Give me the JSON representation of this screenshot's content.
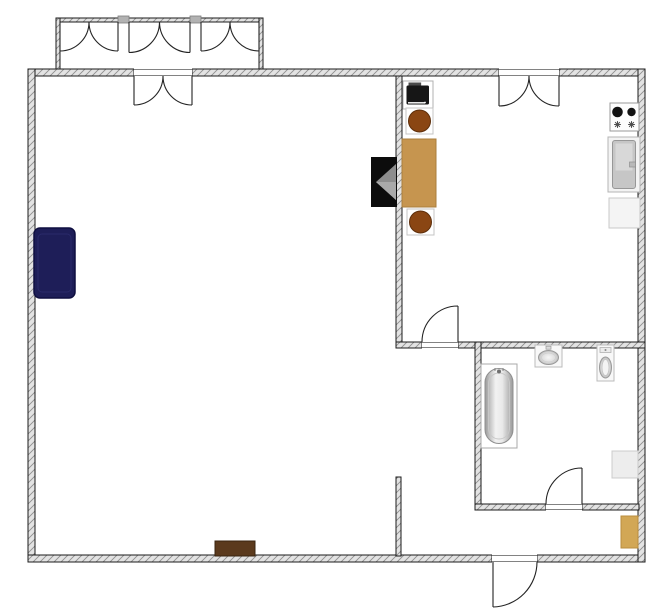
{
  "floorplan": {
    "canvas": {
      "width": 658,
      "height": 611,
      "background": "#ffffff"
    },
    "style": {
      "wall_fill": "#e3e3e3",
      "wall_hatch": "#909090",
      "wall_stroke": "#1b1b1b",
      "door_stroke": "#242424",
      "threshold_stroke": "#5a5a5a",
      "mullion_fill": "#b2b2b2",
      "mullion_stroke": "#7d7d7d"
    },
    "walls": [
      {
        "name": "top-left",
        "x": 28,
        "y": 69,
        "w": 106,
        "h": 7
      },
      {
        "name": "top-mid",
        "x": 192,
        "y": 69,
        "w": 307,
        "h": 7
      },
      {
        "name": "top-right",
        "x": 559,
        "y": 69,
        "w": 86,
        "h": 7
      },
      {
        "name": "left",
        "x": 28,
        "y": 69,
        "w": 7,
        "h": 493
      },
      {
        "name": "bottom-left",
        "x": 28,
        "y": 555,
        "w": 464,
        "h": 7
      },
      {
        "name": "bottom-right",
        "x": 537,
        "y": 555,
        "w": 108,
        "h": 7
      },
      {
        "name": "right",
        "x": 638,
        "y": 69,
        "w": 7,
        "h": 493
      },
      {
        "name": "kitchen-separator",
        "x": 396,
        "y": 76,
        "w": 6,
        "h": 266
      },
      {
        "name": "kitchen-bottom-left",
        "x": 396,
        "y": 342,
        "w": 26,
        "h": 6
      },
      {
        "name": "kitchen-bottom-right",
        "x": 458,
        "y": 342,
        "w": 187,
        "h": 6
      },
      {
        "name": "bathroom-left",
        "x": 475,
        "y": 342,
        "w": 6,
        "h": 168
      },
      {
        "name": "bathroom-bottom-left",
        "x": 475,
        "y": 504,
        "w": 71,
        "h": 6
      },
      {
        "name": "bathroom-bottom-right",
        "x": 582,
        "y": 504,
        "w": 57,
        "h": 6
      },
      {
        "name": "hall-stub",
        "x": 396,
        "y": 477,
        "w": 5,
        "h": 79
      }
    ],
    "bay": {
      "walls": [
        {
          "name": "bay-top",
          "x": 56,
          "y": 18,
          "w": 207,
          "h": 4
        },
        {
          "name": "bay-left",
          "x": 56,
          "y": 18,
          "w": 4,
          "h": 51
        },
        {
          "name": "bay-right",
          "x": 259,
          "y": 18,
          "w": 4,
          "h": 51
        }
      ],
      "mullions": [
        {
          "x": 118,
          "y": 16,
          "w": 11,
          "h": 7
        },
        {
          "x": 190,
          "y": 16,
          "w": 11,
          "h": 7
        }
      ]
    },
    "openings": [
      {
        "name": "balcony-door-opening",
        "x": 134,
        "y": 69,
        "w": 58,
        "h": 7
      },
      {
        "name": "kitchen-double-door-opening",
        "x": 499,
        "y": 69,
        "w": 60,
        "h": 7
      },
      {
        "name": "kitchen-door-opening",
        "x": 422,
        "y": 342,
        "w": 36,
        "h": 6
      },
      {
        "name": "bathroom-door-opening",
        "x": 546,
        "y": 504,
        "w": 36,
        "h": 6
      },
      {
        "name": "entrance-door-opening",
        "x": 492,
        "y": 555,
        "w": 45,
        "h": 7
      }
    ],
    "windows": [
      {
        "name": "bay-window-1-left-casement",
        "d": "M60 22 L60 51 M89 22 A29 29 0 0 1 60 51"
      },
      {
        "name": "bay-window-1-right-casement",
        "d": "M118 22 L118 51 M89 22 A29 29 0 0 0 118 51"
      },
      {
        "name": "bay-window-2-left-casement",
        "d": "M129 22 L129 52.5 M159.5 22 A30.5 30.5 0 0 1 129 52.5"
      },
      {
        "name": "bay-window-2-right-casement",
        "d": "M190 22 L190 52.5 M159.5 22 A30.5 30.5 0 0 0 190 52.5"
      },
      {
        "name": "bay-window-3-left-casement",
        "d": "M201 22 L201 51 M230 22 A29 29 0 0 1 201 51"
      },
      {
        "name": "bay-window-3-right-casement",
        "d": "M259 22 L259 51 M230 22 A29 29 0 0 0 259 51"
      }
    ],
    "doors": [
      {
        "name": "balcony-door-left-leaf",
        "d": "M134 76 L134 105 M163 76 A29 29 0 0 1 134 105"
      },
      {
        "name": "balcony-door-right-leaf",
        "d": "M192 76 L192 105 M163 76 A29 29 0 0 0 192 105"
      },
      {
        "name": "kitchen-double-door-left-leaf",
        "d": "M499 76 L499 106 M529 76 A30 30 0 0 1 499 106"
      },
      {
        "name": "kitchen-double-door-right-leaf",
        "d": "M559 76 L559 106 M529 76 A30 30 0 0 0 559 106"
      },
      {
        "name": "kitchen-door",
        "d": "M458 342 L458 306 M422 342 A36 36 0 0 1 458 306"
      },
      {
        "name": "bathroom-door",
        "d": "M582 504 L582 468 M546 504 A36 36 0 0 1 582 468"
      },
      {
        "name": "entrance-door",
        "d": "M493 562 L493 607 M537 562 A45 45 0 0 1 493 607"
      }
    ],
    "furniture": [
      {
        "name": "sofa",
        "kind": "sofa",
        "x": 34,
        "y": 228,
        "w": 41,
        "h": 70,
        "fill": "#1e1e58",
        "stroke": "#0f0f40"
      },
      {
        "name": "tv",
        "kind": "tv",
        "x": 371,
        "y": 157,
        "w": 26,
        "h": 50,
        "fill": "#0c0c0c",
        "accent": "#8d8d8d"
      },
      {
        "name": "kitchen-appliance",
        "kind": "appliance",
        "x": 403,
        "y": 81,
        "w": 30,
        "h": 28,
        "fill": "#ffffff",
        "accent": "#161616"
      },
      {
        "name": "stool-1",
        "kind": "stool",
        "x": 406,
        "y": 108,
        "w": 27,
        "h": 26,
        "fill": "#8a4613",
        "stroke": "#5e2f0b"
      },
      {
        "name": "dining-table",
        "kind": "table",
        "x": 402,
        "y": 139,
        "w": 34,
        "h": 68,
        "fill": "#c6954f",
        "stroke": "#a97e3d"
      },
      {
        "name": "stool-2",
        "kind": "stool",
        "x": 407,
        "y": 209,
        "w": 27,
        "h": 26,
        "fill": "#8a4613",
        "stroke": "#5e2f0b"
      },
      {
        "name": "cooktop",
        "kind": "cooktop",
        "x": 610,
        "y": 103,
        "w": 29,
        "h": 28,
        "fill": "#fdfdfd",
        "accent": "#121212"
      },
      {
        "name": "kitchen-sink",
        "kind": "sink-counter",
        "x": 608,
        "y": 137,
        "w": 32,
        "h": 55,
        "fill": "#f3f3f3",
        "accent": "#c6c6c6"
      },
      {
        "name": "kitchen-cabinet",
        "kind": "cabinet",
        "x": 609,
        "y": 198,
        "w": 31,
        "h": 30,
        "fill": "#f4f4f4",
        "stroke": "#c9c9c9"
      },
      {
        "name": "bathtub",
        "kind": "bathtub",
        "x": 481,
        "y": 364,
        "w": 36,
        "h": 84,
        "fill": "#ffffff",
        "stroke": "#a8a8a8"
      },
      {
        "name": "bathroom-sink",
        "kind": "bath-sink",
        "x": 535,
        "y": 345,
        "w": 27,
        "h": 22,
        "fill": "#f8f8f8",
        "stroke": "#bbbbbb"
      },
      {
        "name": "toilet",
        "kind": "toilet",
        "x": 597,
        "y": 345,
        "w": 17,
        "h": 36,
        "fill": "#f8f8f8",
        "stroke": "#bbbbbb"
      },
      {
        "name": "bathroom-cabinet",
        "kind": "cabinet",
        "x": 612,
        "y": 451,
        "w": 26,
        "h": 27,
        "fill": "#ededed",
        "stroke": "#cccccc"
      },
      {
        "name": "hall-cabinet",
        "kind": "cabinet",
        "x": 621,
        "y": 516,
        "w": 17,
        "h": 32,
        "fill": "#d2a755",
        "stroke": "#b98d3e"
      },
      {
        "name": "sideboard",
        "kind": "cabinet",
        "x": 215,
        "y": 541,
        "w": 40,
        "h": 15,
        "fill": "#5b3a1d",
        "stroke": "#3a2410"
      }
    ]
  }
}
